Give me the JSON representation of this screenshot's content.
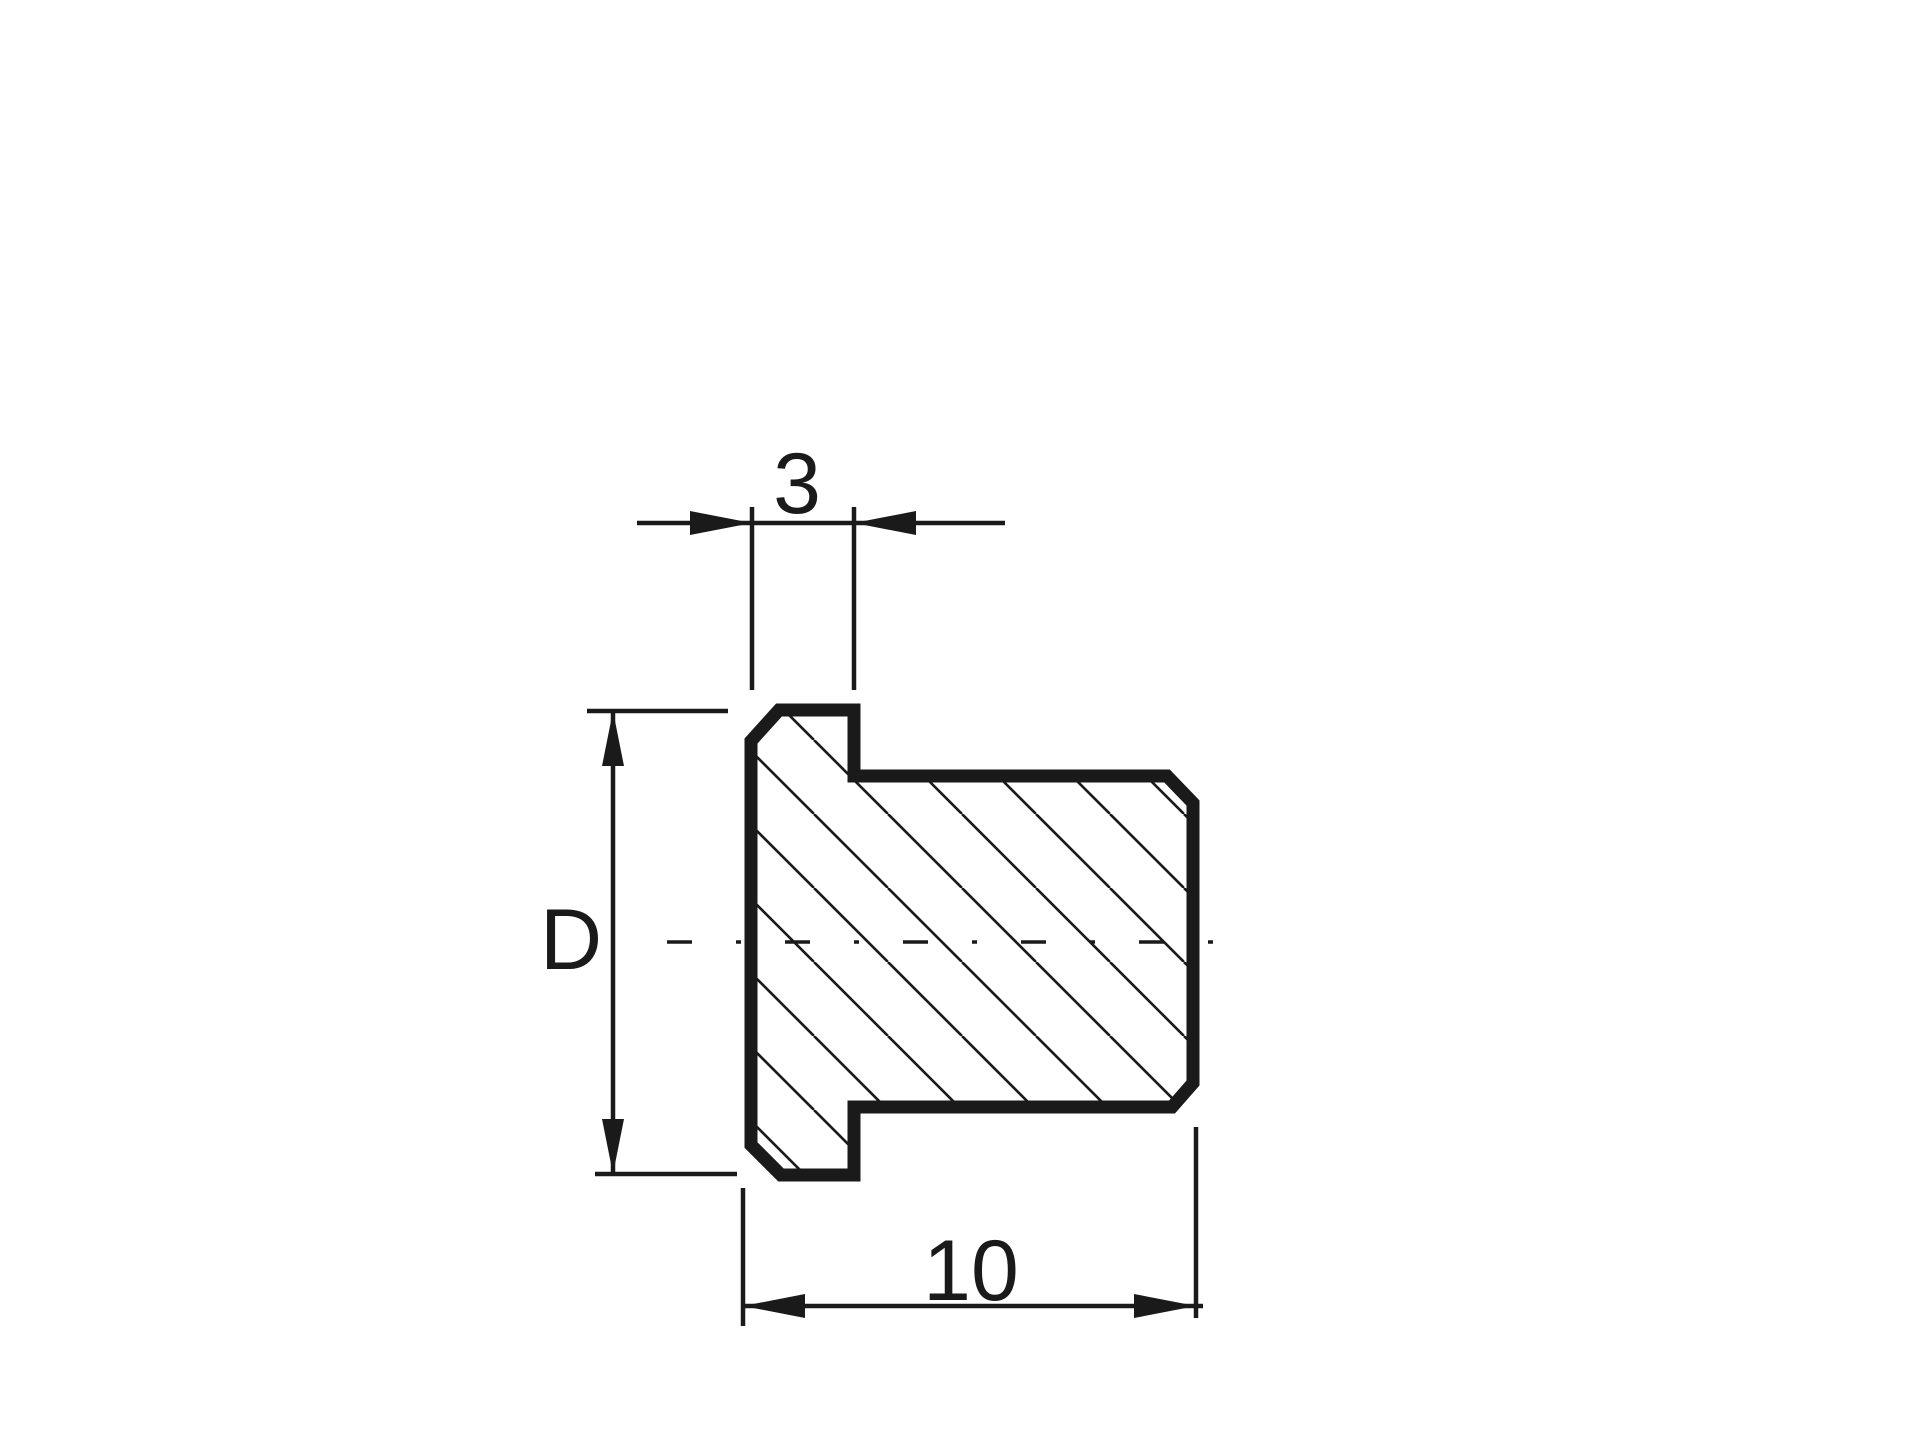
{
  "drawing": {
    "kind": "technical-section-drawing",
    "background_color": "#ffffff",
    "line_color": "#1a1a1a",
    "section_hatch": "diagonal-45deg",
    "dimension_labels": {
      "flange_width": "3",
      "diameter": "D",
      "overall_length": "10"
    }
  }
}
